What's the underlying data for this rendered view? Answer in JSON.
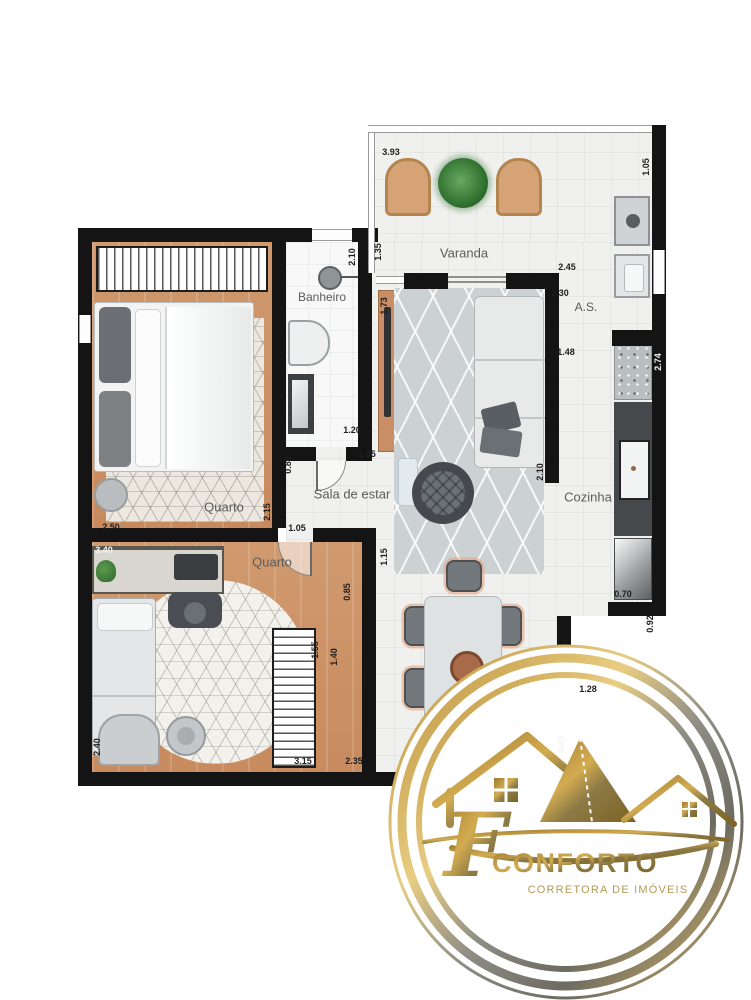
{
  "meta": {
    "type": "apartment floor plan"
  },
  "rooms": {
    "varanda": {
      "label": "Varanda"
    },
    "banheiro": {
      "label": "Banheiro"
    },
    "sala": {
      "label": "Sala de estar"
    },
    "as": {
      "label": "A.S."
    },
    "cozinha": {
      "label": "Cozinha"
    },
    "quarto1": {
      "label": "Quarto"
    },
    "quarto2": {
      "label": "Quarto"
    }
  },
  "dimensions": [
    {
      "text": "3.93",
      "x": 391,
      "y": 152
    },
    {
      "text": "1.05",
      "x": 646,
      "y": 167,
      "v": true
    },
    {
      "text": "2.10",
      "x": 352,
      "y": 257,
      "v": true
    },
    {
      "text": "1.35",
      "x": 378,
      "y": 252,
      "v": true
    },
    {
      "text": "2.45",
      "x": 567,
      "y": 267
    },
    {
      "text": "2.30",
      "x": 560,
      "y": 293
    },
    {
      "text": "1.73",
      "x": 384,
      "y": 306,
      "v": true
    },
    {
      "text": "1.48",
      "x": 566,
      "y": 352
    },
    {
      "text": "2.74",
      "x": 658,
      "y": 362,
      "v": true,
      "w": true
    },
    {
      "text": "1.20",
      "x": 352,
      "y": 430
    },
    {
      "text": "1.35",
      "x": 367,
      "y": 454
    },
    {
      "text": "0.80",
      "x": 288,
      "y": 465,
      "v": true
    },
    {
      "text": "2.10",
      "x": 540,
      "y": 472,
      "v": true
    },
    {
      "text": "2.15",
      "x": 267,
      "y": 512,
      "v": true
    },
    {
      "text": "2.50",
      "x": 111,
      "y": 527
    },
    {
      "text": "1.05",
      "x": 297,
      "y": 528
    },
    {
      "text": "1.15",
      "x": 384,
      "y": 557,
      "v": true
    },
    {
      "text": "3.40",
      "x": 104,
      "y": 550,
      "w": true
    },
    {
      "text": "0.85",
      "x": 347,
      "y": 592,
      "v": true
    },
    {
      "text": "1.55",
      "x": 315,
      "y": 650,
      "v": true
    },
    {
      "text": "1.40",
      "x": 334,
      "y": 657,
      "v": true
    },
    {
      "text": "0.70",
      "x": 623,
      "y": 594
    },
    {
      "text": "0.92",
      "x": 650,
      "y": 624,
      "v": true
    },
    {
      "text": "3.15",
      "x": 303,
      "y": 761
    },
    {
      "text": "2.35",
      "x": 354,
      "y": 761
    },
    {
      "text": "2.40",
      "x": 97,
      "y": 747,
      "v": true
    },
    {
      "text": "1.28",
      "x": 588,
      "y": 689
    },
    {
      "text": "0.82",
      "x": 561,
      "y": 744,
      "v": true,
      "w": true
    }
  ],
  "logo": {
    "monogram": "F",
    "brand": "CONFORTO",
    "tagline": "CORRETORA DE IMÓVEIS",
    "gold": "#b08a3c"
  }
}
